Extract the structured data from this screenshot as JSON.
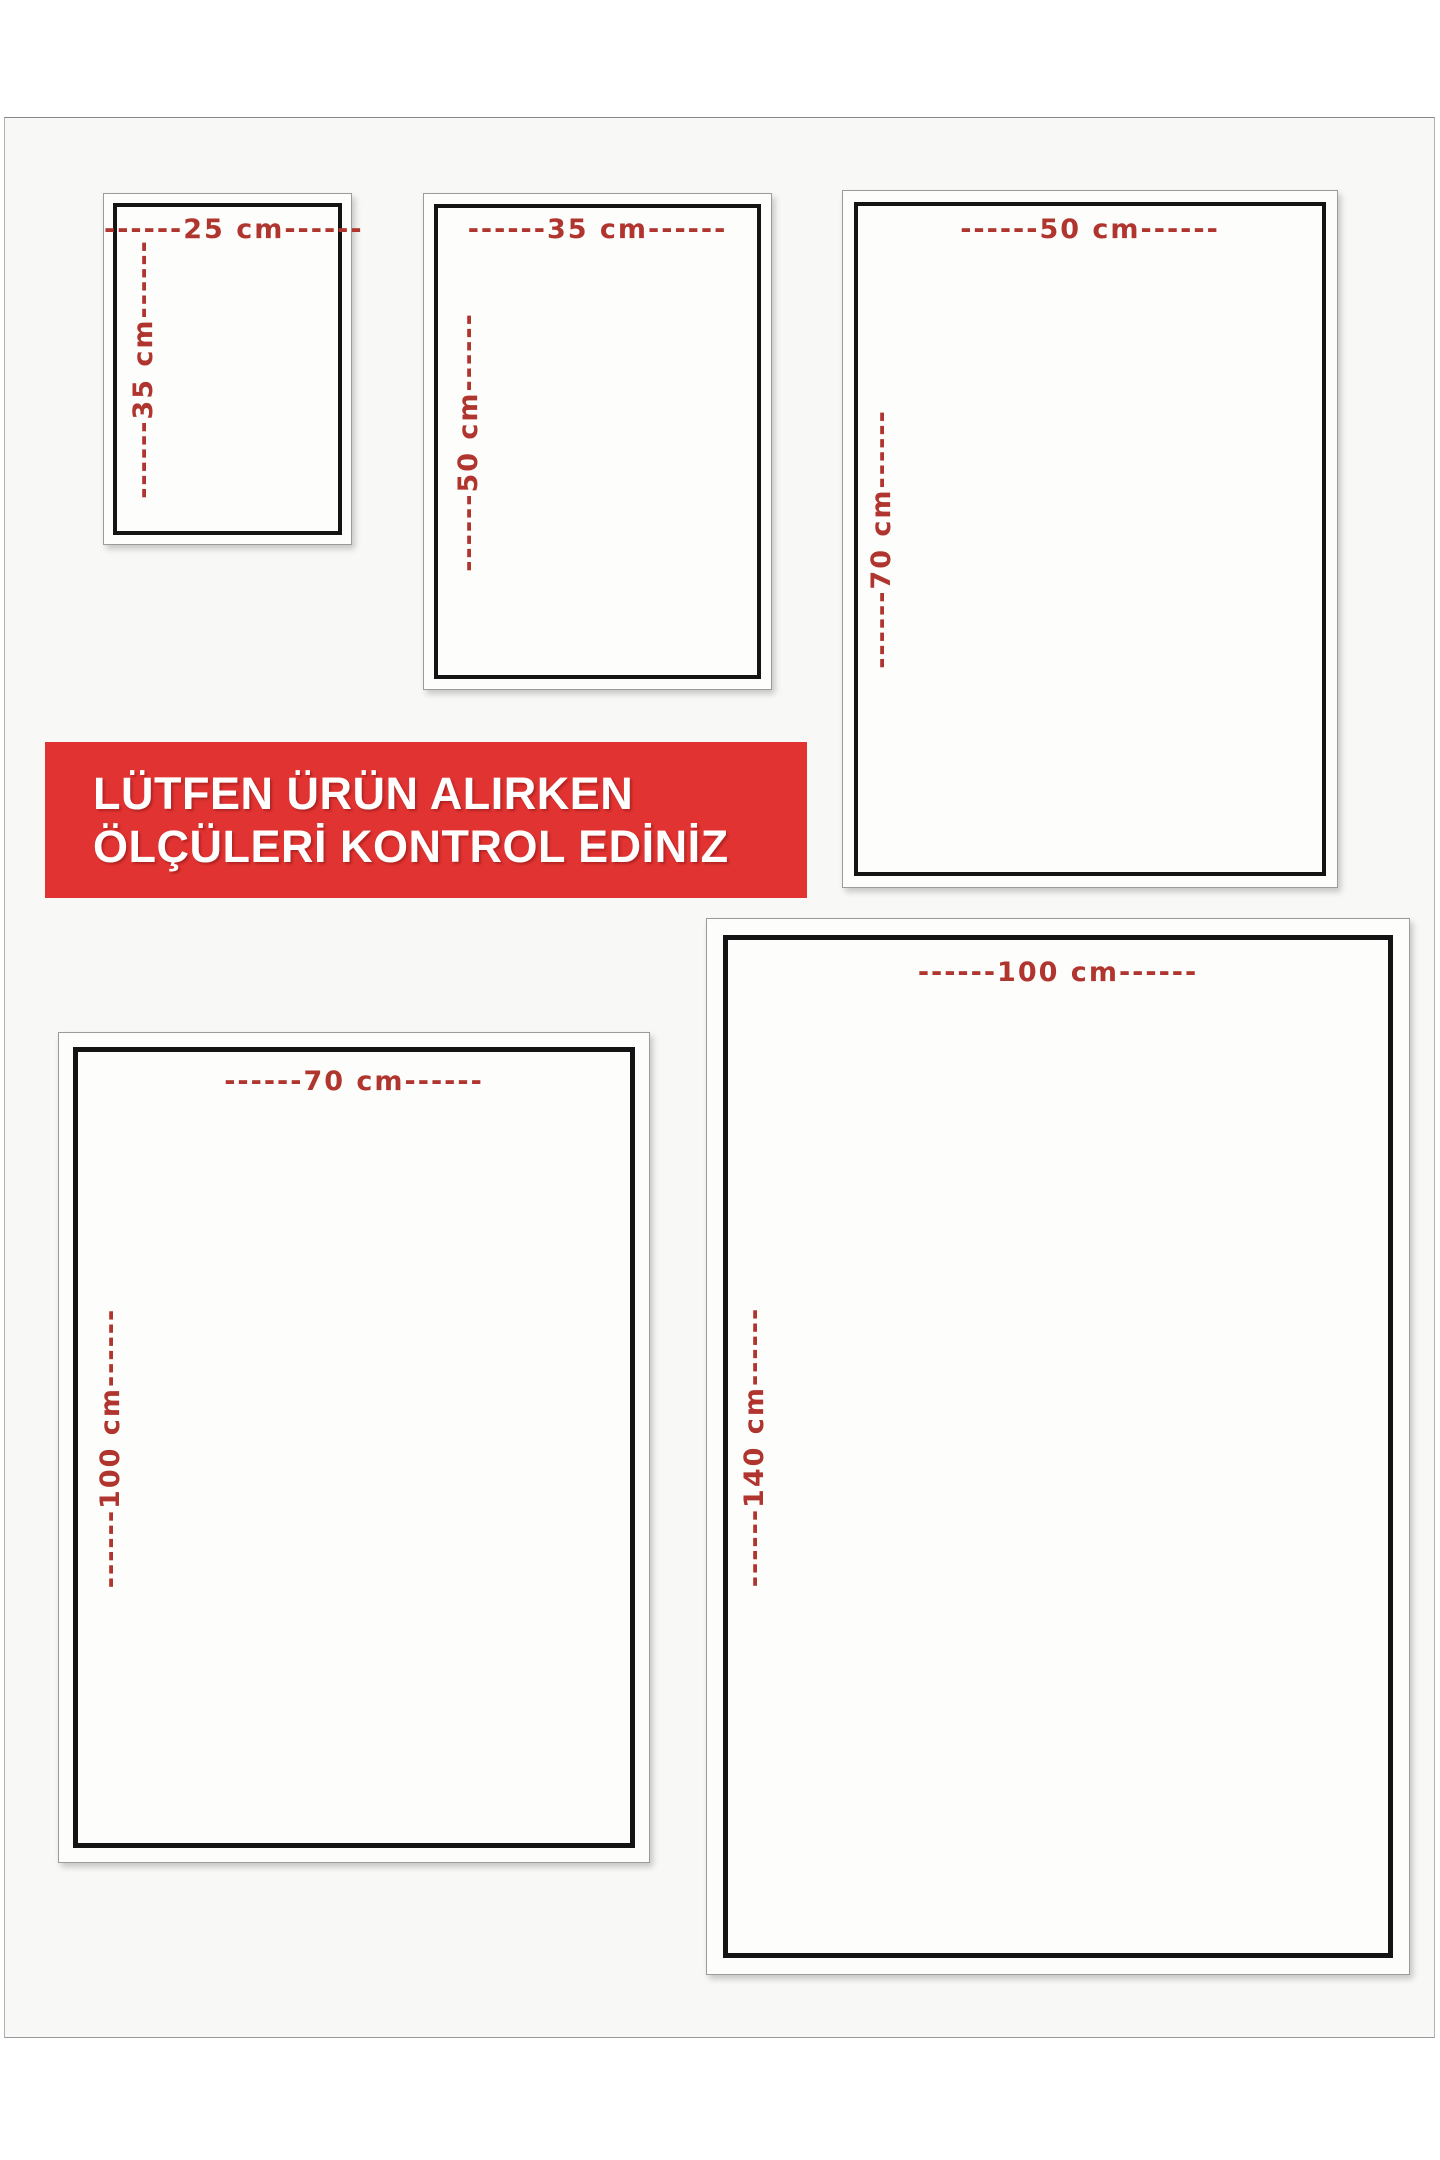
{
  "banner": {
    "line1": "LÜTFEN ÜRÜN ALIRKEN",
    "line2": "ÖLÇÜLERİ KONTROL EDİNİZ"
  },
  "colors": {
    "banner_red": "#e13331",
    "dimension_red": "#b0352e",
    "frame_black": "#141414",
    "page_background": "#f8f8f6"
  },
  "sizes": [
    {
      "width_cm": 25,
      "height_cm": 35,
      "width_label": "------25 cm------",
      "height_label": "------35 cm------"
    },
    {
      "width_cm": 35,
      "height_cm": 50,
      "width_label": "------35 cm------",
      "height_label": "------50 cm------"
    },
    {
      "width_cm": 50,
      "height_cm": 70,
      "width_label": "------50 cm------",
      "height_label": "------70 cm------"
    },
    {
      "width_cm": 70,
      "height_cm": 100,
      "width_label": "------70 cm------",
      "height_label": "------100 cm------"
    },
    {
      "width_cm": 100,
      "height_cm": 140,
      "width_label": "------100 cm------",
      "height_label": "------140 cm------"
    }
  ]
}
